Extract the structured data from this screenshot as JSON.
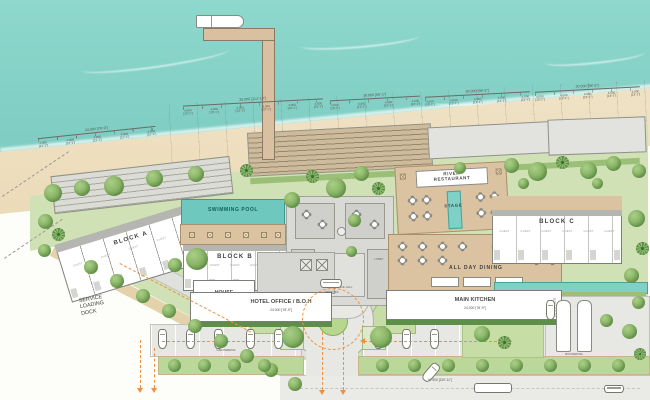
{
  "plan": {
    "swimming_pool": "SWIMMING POOL",
    "block_a": "BLOCK A",
    "block_b": "BLOCK B",
    "block_c": "BLOCK C",
    "guest_label": "GUEST",
    "house_keeping": "HOUSE\nKEEPING",
    "hotel_office": "HOTEL OFFICE / B.O.H",
    "main_kitchen": "MAIN KITCHEN",
    "all_day_dining": "ALL DAY DINING",
    "river_restaurant": "RIVER\nRESTAURANT",
    "stage": "STAGE",
    "service_dock": "SERVICE\nLOADING\nDOCK",
    "reception": "RECEPTION",
    "lobby": "LOBBY",
    "entrance_hall": "ENTRANCE HALL",
    "drop_off": "DROP OFF",
    "car_parking": "CAR PARKING",
    "bus_parking": "BUS PARKING"
  },
  "dims": {
    "seg": "4.000",
    "seg_ft": "[13'-1\"]",
    "groups": [
      {
        "total": "24.000",
        "ft": "[78'-9\"]"
      },
      {
        "total": "35.000",
        "ft": "[114'-10\"]"
      },
      {
        "total": "18.000",
        "ft": "[59'-1\"]"
      },
      {
        "total": "30.000",
        "ft": "[98'-5\"]"
      },
      {
        "total": "30.000",
        "ft": "[98'-5\"]"
      }
    ],
    "office_len": "24.000",
    "office_ft": "[78'-9\"]",
    "kitchen_len": "24.000",
    "kitchen_ft": "[78'-9\"]",
    "kitchen_depth": "5.000 [16'-5\"]",
    "road_len": "97.500 [319'-11\"]"
  },
  "colors": {
    "sea": "#85d0c6",
    "sand": "#eedcbb",
    "lawn": "#cfe1b5",
    "deck": "#d9c1a0",
    "pool": "#6fc8be",
    "route": "#ef9240"
  }
}
